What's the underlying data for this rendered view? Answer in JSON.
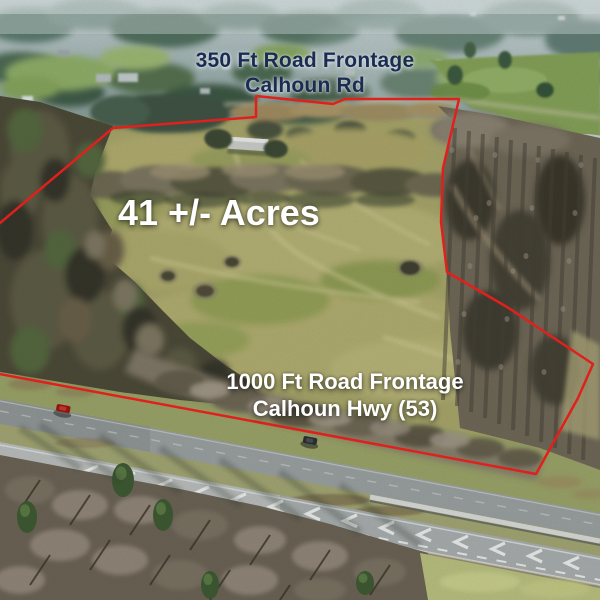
{
  "annotations": {
    "top_frontage": {
      "line1": "350 Ft Road Frontage",
      "line2": "Calhoun Rd"
    },
    "acreage": {
      "text": "41 +/- Acres"
    },
    "bottom_frontage": {
      "line1": "1000 Ft Road Frontage",
      "line2": "Calhoun Hwy (53)"
    }
  },
  "boundary": {
    "points": "-6,228 113,128 256,117 256,96 333,104 345,99 459,99 443,168 441,222 447,272 507,307 593,364 578,398 536,474 -6,373",
    "color": "#e0201c"
  },
  "colors": {
    "top_text": "#1d2b52",
    "overlay_text": "#ffffff",
    "boundary_red": "#e0201c",
    "field_olive": "#a7a56a",
    "forest_dark": "#4c4a38",
    "woods_grey": "#6f6858",
    "road_asphalt": "#9aa0a0",
    "haze_blue": "#9db0af",
    "pond_water": "#c5d0d3"
  }
}
